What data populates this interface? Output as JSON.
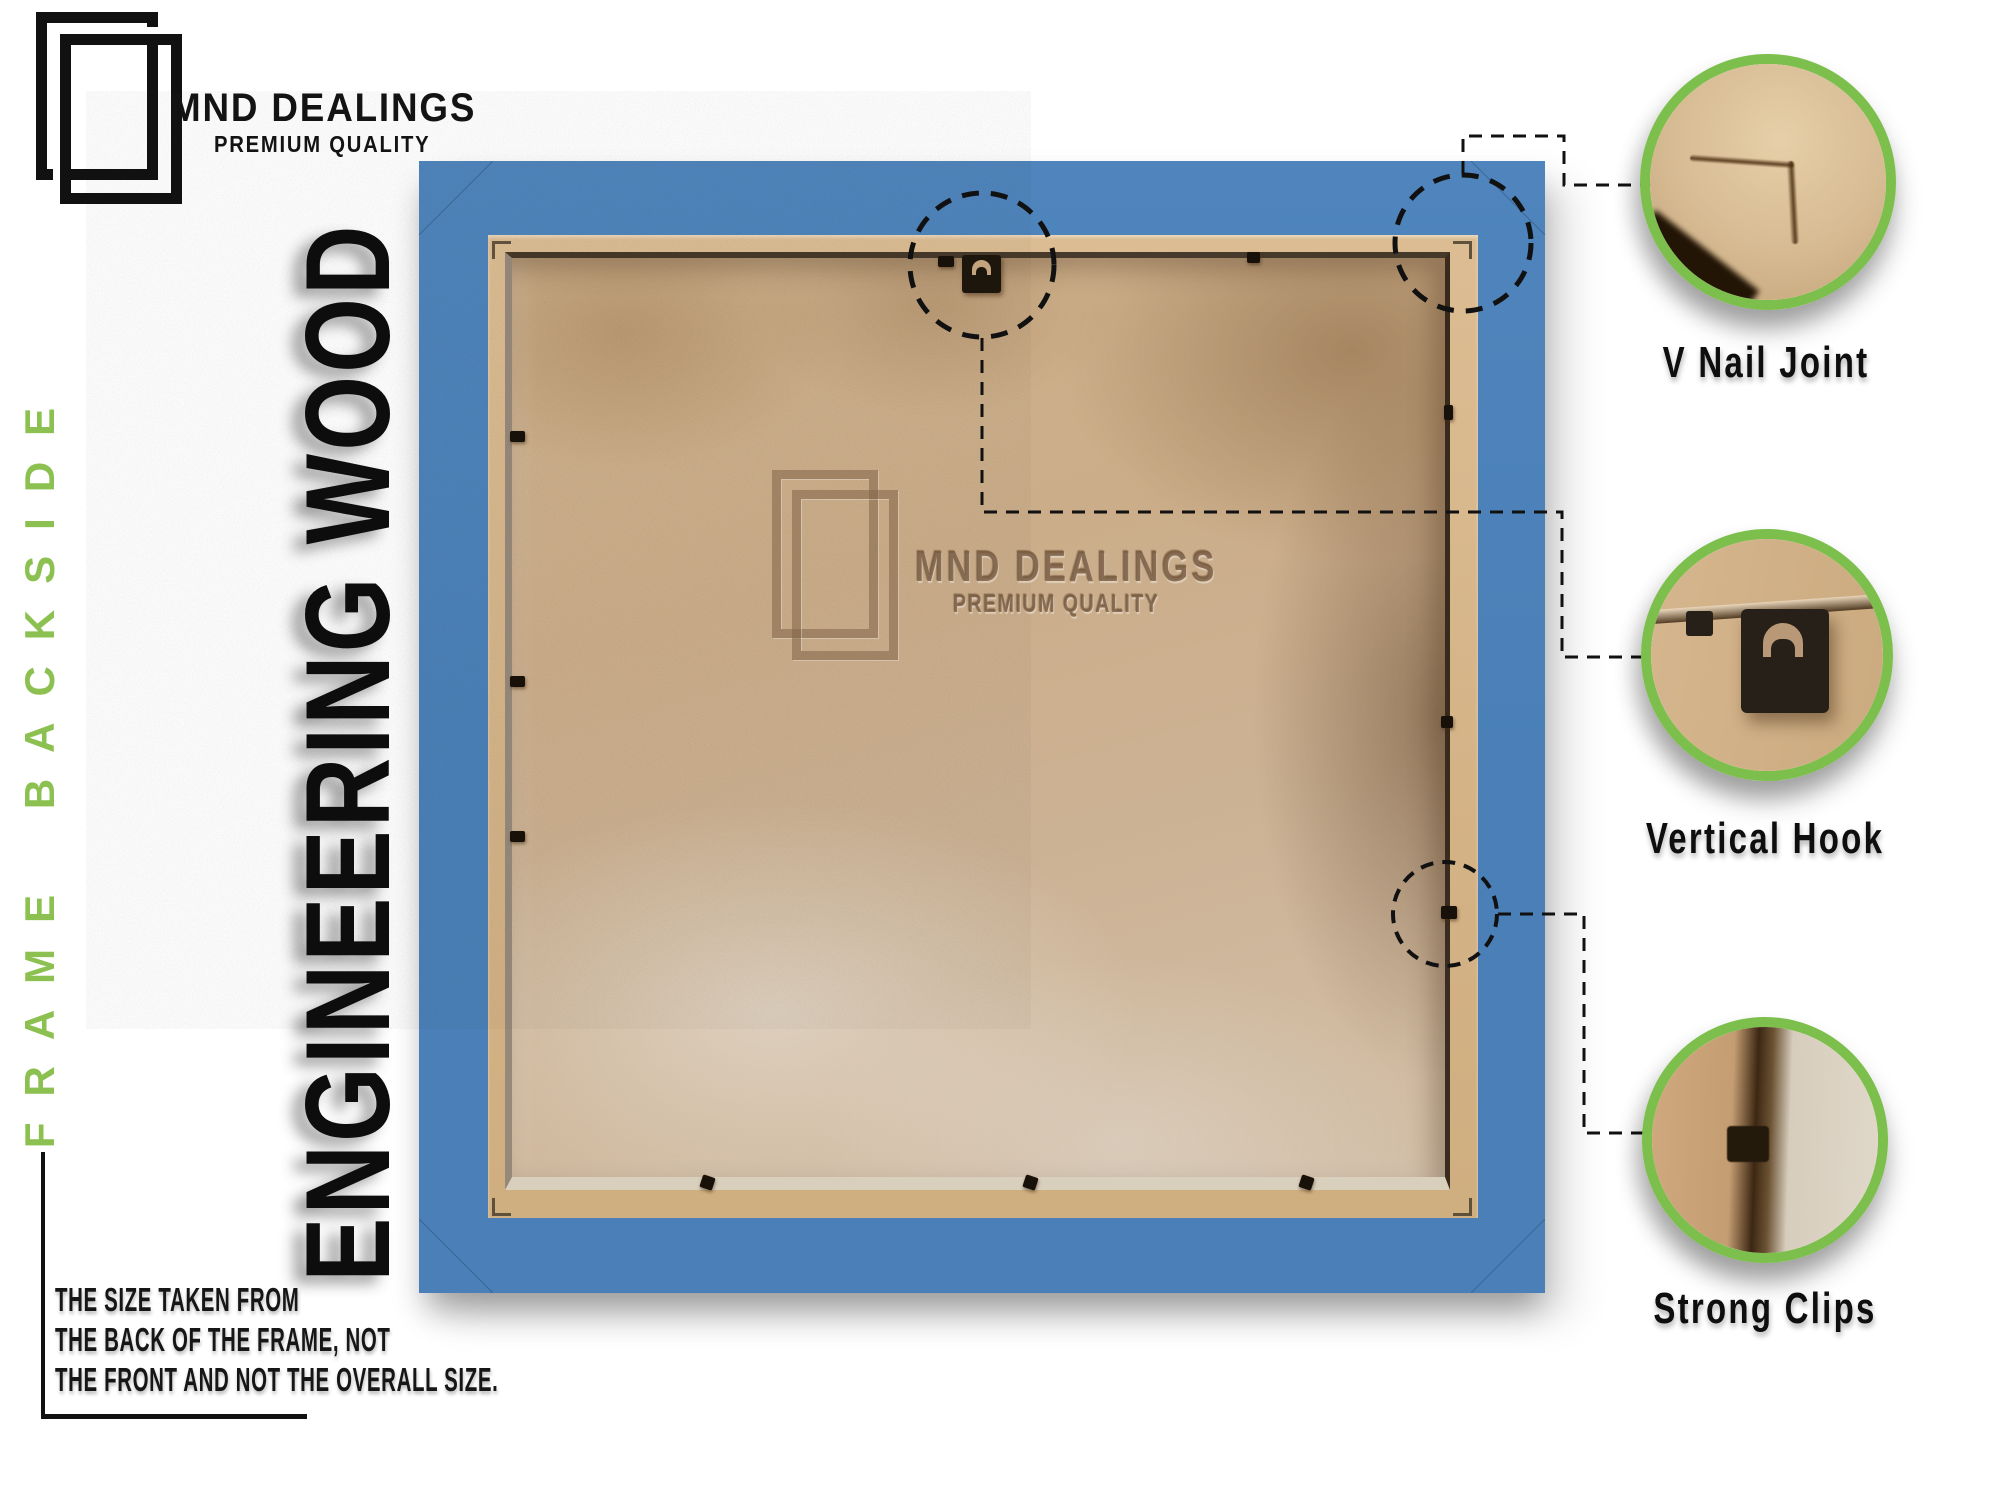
{
  "brand": {
    "name": "MND DEALINGS",
    "tagline": "PREMIUM QUALITY"
  },
  "side_label": "FRAME BACKSIDE",
  "material_label": "ENGINEERING WOOD",
  "watermark": {
    "name": "MND DEALINGS",
    "tagline": "PREMIUM QUALITY"
  },
  "size_note": {
    "lines": [
      "THE SIZE TAKEN FROM",
      "THE BACK OF THE FRAME, NOT",
      "THE FRONT AND NOT THE OVERALL SIZE."
    ]
  },
  "callouts": [
    {
      "label": "V Nail Joint"
    },
    {
      "label": "Vertical Hook"
    },
    {
      "label": "Strong Clips"
    }
  ],
  "colors": {
    "frame_blue": "#4a80b7",
    "callout_green": "#7cbf4c",
    "side_label_green": "#8cc152"
  }
}
